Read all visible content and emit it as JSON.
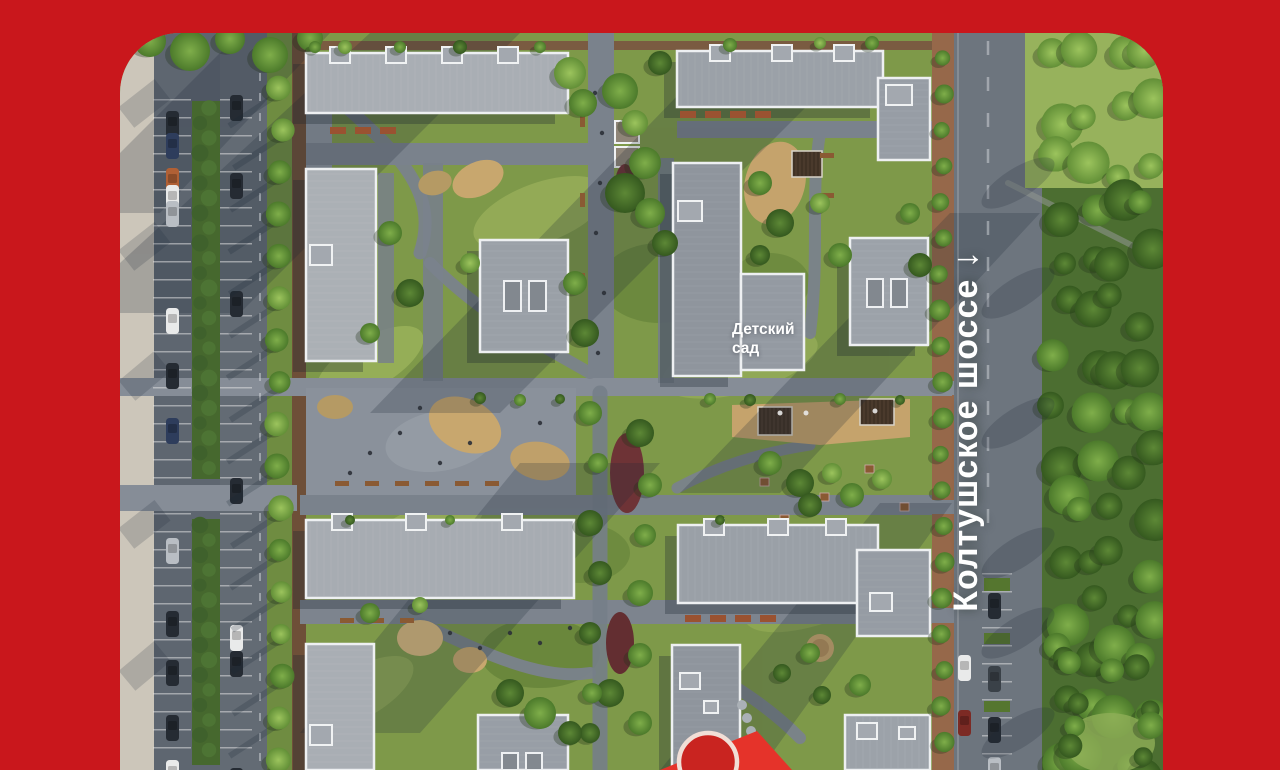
{
  "map": {
    "road_label": "Колтушское шоссе ↓",
    "building_label": "Детский\nсад",
    "marker": {
      "name": "location-pin"
    },
    "colors": {
      "background_red": "#c9171c",
      "pin_red": "#e5332a",
      "pin_circle_red": "#c92420",
      "pin_ring": "#f1ded6",
      "label_white": "#ffffff",
      "roof_gray": "#a0a6ad",
      "lawn_green": "#7e9949",
      "asphalt_gray": "#6d757e"
    }
  }
}
